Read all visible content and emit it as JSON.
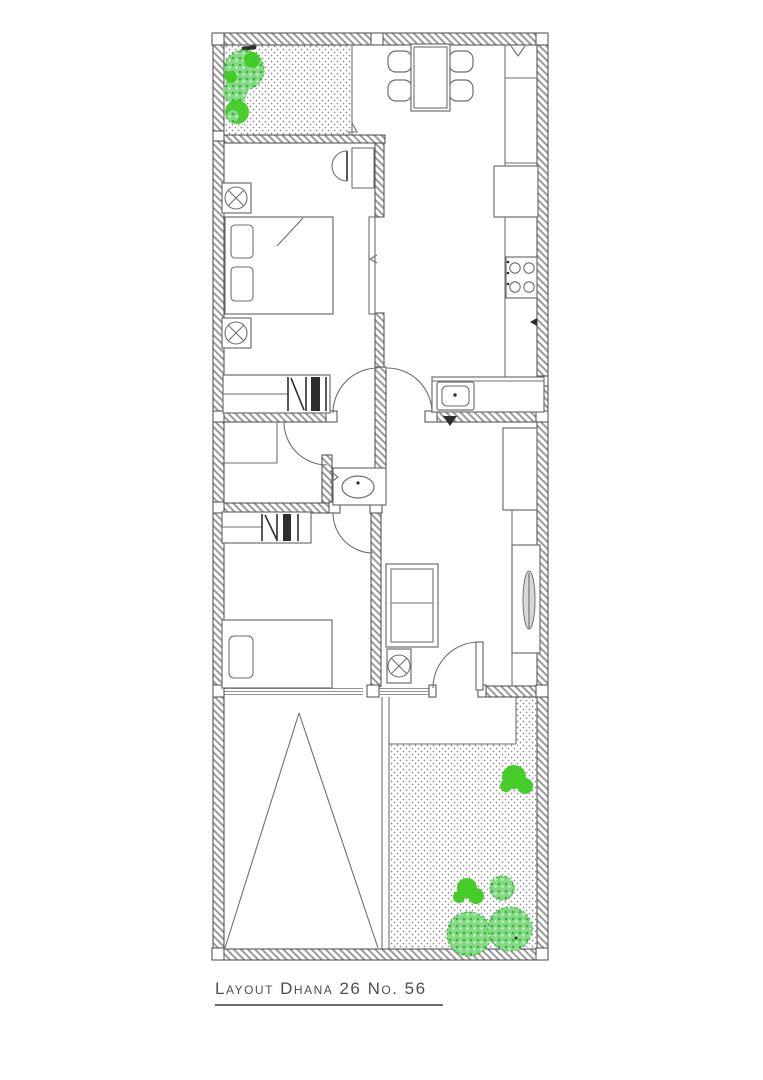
{
  "title": {
    "text": "Layout Dhana 26 No. 56"
  },
  "colors": {
    "paper": "#ffffff",
    "wall_edge": "#4a4a4a",
    "hatch_line": "#9b9b9b",
    "line": "#6f6f6f",
    "line_dark": "#2e2e2e",
    "dot": "#8a8a8a",
    "plant_bright": "#3ccc1e",
    "plant_soft": "#84da84",
    "plant_deep": "#39b339",
    "title_ink": "#4f4f4f"
  },
  "plan": {
    "name": "floor-plan-dhana-26",
    "rooms": [
      {
        "name": "patio-garden"
      },
      {
        "name": "dining-area"
      },
      {
        "name": "kitchen"
      },
      {
        "name": "master-bedroom"
      },
      {
        "name": "hallway"
      },
      {
        "name": "storage-room"
      },
      {
        "name": "bathroom"
      },
      {
        "name": "second-bedroom"
      },
      {
        "name": "living-room"
      },
      {
        "name": "entrance-porch"
      },
      {
        "name": "carport"
      },
      {
        "name": "backyard-garden"
      }
    ],
    "furniture": [
      {
        "name": "dining-table-with-four-chairs"
      },
      {
        "name": "refrigerator"
      },
      {
        "name": "four-burner-stove"
      },
      {
        "name": "kitchen-sink-counter"
      },
      {
        "name": "double-bed-with-pillows"
      },
      {
        "name": "nightstands-with-lamps"
      },
      {
        "name": "wardrobe-master"
      },
      {
        "name": "wardrobe-second-bedroom"
      },
      {
        "name": "washbasin"
      },
      {
        "name": "single-bed"
      },
      {
        "name": "two-seat-sofa"
      },
      {
        "name": "side-table-lamp"
      },
      {
        "name": "tall-cabinet-with-mirror"
      },
      {
        "name": "entrance-door"
      },
      {
        "name": "garden-shrubs"
      },
      {
        "name": "carport-marking-triangle"
      }
    ]
  }
}
